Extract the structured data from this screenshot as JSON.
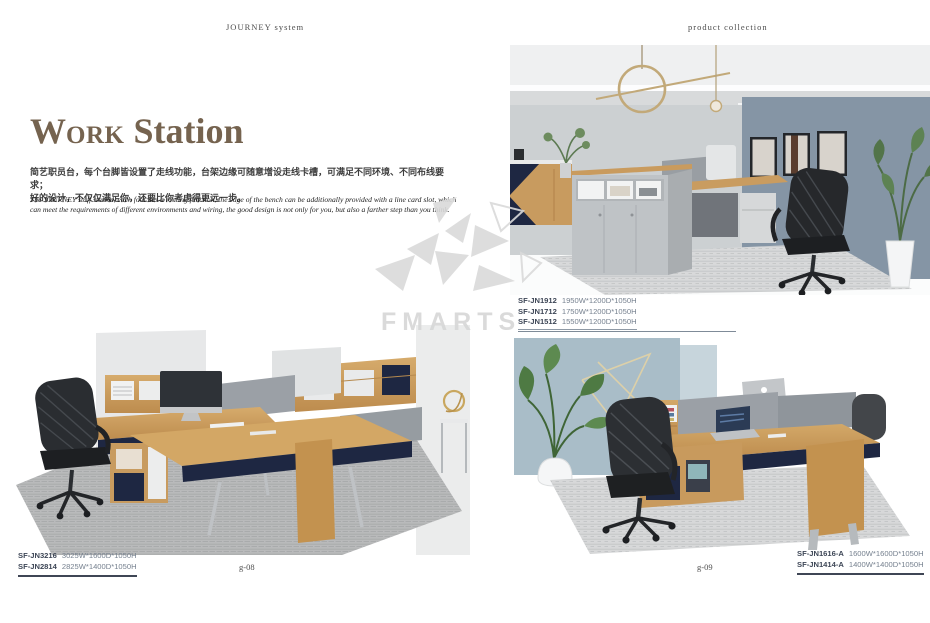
{
  "page": {
    "header_left": "JOURNEY  system",
    "header_right": "product  collection",
    "title": {
      "part1": "W",
      "part2": "ORK",
      "part3": " Station"
    },
    "description_cn_line1": "简艺职员台，每个台脚皆设置了走线功能，台架边缘可随意增设走线卡槽，可满足不同环境、不同布线要求；",
    "description_cn_line2": "好的设计，不仅仅满足你，还要比你考虑得更远一步。",
    "description_en": "The JOURNEY staff station, each foot has a routing function, the edge of the bench can be additionally provided with a line card slot, which can meet the requirements of different environments and wiring, the good design is not only for you, but also a farther step than you think.",
    "watermark": "FMARTS",
    "page_number_left": "g-08",
    "page_number_right": "g-09"
  },
  "products": {
    "left_page": [
      {
        "model": "SF-JN3216",
        "dimensions": "3025W*1600D*1050H"
      },
      {
        "model": "SF-JN2814",
        "dimensions": "2825W*1400D*1050H"
      }
    ],
    "right_page_top": [
      {
        "model": "SF-JN1912",
        "dimensions": "1950W*1200D*1050H"
      },
      {
        "model": "SF-JN1712",
        "dimensions": "1750W*1200D*1050H"
      },
      {
        "model": "SF-JN1512",
        "dimensions": "1550W*1200D*1050H"
      }
    ],
    "right_page_bottom": [
      {
        "model": "SF-JN1616-A",
        "dimensions": "1600W*1600D*1050H"
      },
      {
        "model": "SF-JN1414-A",
        "dimensions": "1400W*1400D*1050H"
      }
    ]
  },
  "images": {
    "left_photo_alt": "Four-seat wooden bench workstation with navy panels, grey fabric dividers, hutch cubbies, iMac and black mesh office chair on grey rug",
    "top_right_photo_alt": "Reception office with grey counter cabinet, wooden desk, black mesh chair, blue-grey accent wall with three framed pictures, gold ring pendant light and potted plants",
    "bottom_right_photo_alt": "Two-seat wooden workstation with grey fabric divider, navy storage, laptop, black mesh chair, light blue wall panels and green plant"
  },
  "colors": {
    "title": "#75634f",
    "wood": "#cc9f62",
    "navy": "#1e2742",
    "fabric_grey": "#9ba0a6",
    "accent_wall": "#8595a5",
    "blue_panel": "#a9bdc8",
    "rug": "#babcbd",
    "model_text": "#3d4656"
  }
}
